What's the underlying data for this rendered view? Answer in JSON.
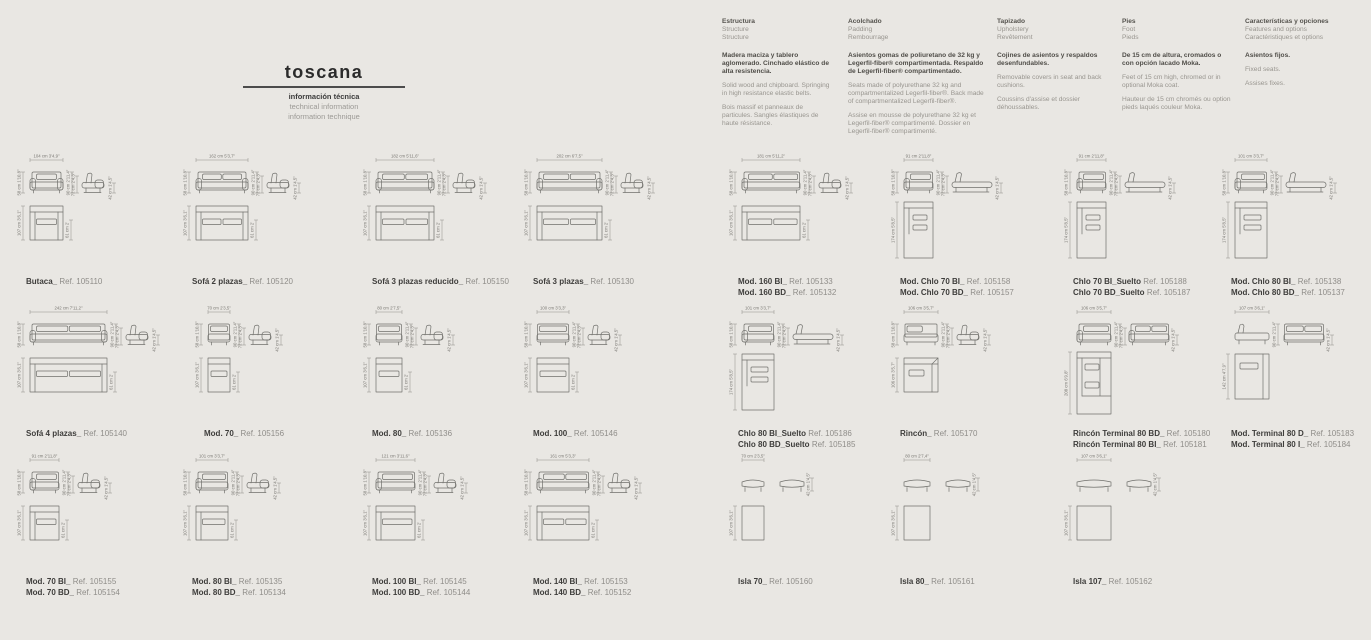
{
  "colors": {
    "background": "#e9e7e3",
    "line": "#70706c",
    "text_dark": "#3e3d3b",
    "text_muted": "#8f8d89"
  },
  "title": {
    "name": "toscana",
    "line1": "información técnica",
    "line2": "technical information",
    "line3": "information technique"
  },
  "info_columns": [
    {
      "heading": [
        "Estructura",
        "Structure",
        "Structure"
      ],
      "lead": "Madera maciza y tablero aglomerado. Cinchado elástico de alta resistencia.",
      "paragraphs": [
        "Solid wood and chipboard. Springing in high resistance elastic belts.",
        "Bois massif et panneaux de particules. Sangles élastiques de haute résistance."
      ]
    },
    {
      "heading": [
        "Acolchado",
        "Padding",
        "Rembourrage"
      ],
      "lead": "Asientos gomas de poliuretano de 32 kg y Legerfil-fiber® compartimentada. Respaldo de Legerfil-fiber® compartimentado.",
      "paragraphs": [
        "Seats made of polyurethane 32 kg and compartmentalized Legerfil-fiber®. Back made of compartmentalized Legerfil-fiber®.",
        "Assise en mousse de polyurethane 32 kg et Legerfil-fiber® compartimenté. Dossier en Legerfil-fiber® compartimenté."
      ]
    },
    {
      "heading": [
        "Tapizado",
        "Upholstery",
        "Revêtement"
      ],
      "lead": "Cojines de asientos y respaldos desenfundables.",
      "paragraphs": [
        "Removable covers in seat and back cushions.",
        "Coussins d'assise et dossier déhoussables."
      ]
    },
    {
      "heading": [
        "Pies",
        "Foot",
        "Pieds"
      ],
      "lead": "De 15 cm de altura, cromados o con opción lacado Moka.",
      "paragraphs": [
        "Feet of 15 cm high, chromed or in optional Moka coat.",
        "Hauteur de 15 cm chromés ou option pieds laqués couleur Moka."
      ]
    },
    {
      "heading": [
        "Características y opciones",
        "Features and options",
        "Caractéristiques et options"
      ],
      "lead": "Asientos fijos.",
      "paragraphs": [
        "Fixed seats.",
        "Assises fixes."
      ]
    }
  ],
  "cells": [
    {
      "id": "butaca",
      "labels": [
        {
          "name": "Butaca_",
          "ref": "Ref. 105110"
        }
      ],
      "dims": {
        "w": "104 cm 3'4,9\"",
        "h1": "58 cm 1'10,8\"",
        "h2": "90 cm 2'11,4\"",
        "h3": "72 cm 2'4,3\"",
        "h4": "42 cm 1'4,5\"",
        "pd": "107 cm 3'6,1\"",
        "sd": "61 cm 2'"
      }
    },
    {
      "id": "sofa-2-plazas",
      "labels": [
        {
          "name": "Sofá 2 plazas_",
          "ref": "Ref. 105120"
        }
      ],
      "dims": {
        "w": "162 cm 5'3,7\"",
        "h1": "58 cm 1'10,8\"",
        "h2": "90 cm 2'11,4\"",
        "h3": "72 cm 2'4,3\"",
        "h4": "42 cm 1'4,5\"",
        "pd": "107 cm 3'6,1\"",
        "sd": "61 cm 2'"
      }
    },
    {
      "id": "sofa-3-plazas-reducido",
      "labels": [
        {
          "name": "Sofá 3 plazas reducido_",
          "ref": "Ref. 105150"
        }
      ],
      "dims": {
        "w": "182 cm 5'11,6\"",
        "h1": "58 cm 1'10,8\"",
        "h2": "90 cm 2'11,4\"",
        "h3": "72 cm 2'4,3\"",
        "h4": "42 cm 1'4,5\"",
        "pd": "107 cm 3'6,1\"",
        "sd": "61 cm 2'"
      }
    },
    {
      "id": "sofa-3-plazas",
      "labels": [
        {
          "name": "Sofá 3 plazas_",
          "ref": "Ref. 105130"
        }
      ],
      "dims": {
        "w": "202 cm 6'7,5\"",
        "h1": "58 cm 1'10,8\"",
        "h2": "90 cm 2'11,4\"",
        "h3": "72 cm 2'4,3\"",
        "h4": "42 cm 1'4,5\"",
        "pd": "107 cm 3'6,1\"",
        "sd": "61 cm 2'"
      }
    },
    {
      "id": "mod-160",
      "labels": [
        {
          "name": "Mod. 160 BI_",
          "ref": "Ref. 105133"
        },
        {
          "name": "Mod. 160 BD_",
          "ref": "Ref. 105132"
        }
      ],
      "dims": {
        "w": "181 cm 5'11,2\"",
        "h1": "58 cm 1'10,8\"",
        "h2": "90 cm 2'11,4\"",
        "h3": "72 cm 2'4,3\"",
        "h4": "42 cm 1'4,5\"",
        "pd": "107 cm 3'6,1\"",
        "sd": "61 cm 2'"
      }
    },
    {
      "id": "mod-chlo-70",
      "labels": [
        {
          "name": "Mod. Chlo 70 BI_",
          "ref": "Ref. 105158"
        },
        {
          "name": "Mod. Chlo 70 BD_",
          "ref": "Ref. 105157"
        }
      ],
      "dims": {
        "w": "91 cm 2'11,8\"",
        "h1": "58 cm 1'10,8\"",
        "h2": "90 cm 2'11,4\"",
        "h3": "72 cm 2'4,3\"",
        "h4": "42 cm 1'4,5\"",
        "pd": "174 cm 5'8,5\""
      }
    },
    {
      "id": "chlo-70-suelto",
      "labels": [
        {
          "name": "Chlo 70 BI_Suelto",
          "ref": "Ref. 105188"
        },
        {
          "name": "Chlo 70 BD_Suelto",
          "ref": "Ref. 105187"
        }
      ],
      "dims": {
        "w": "91 cm 2'11,8\"",
        "h1": "58 cm 1'10,8\"",
        "h2": "90 cm 2'11,4\"",
        "h3": "72 cm 2'4,3\"",
        "h4": "42 cm 1'4,5\"",
        "pd": "174 cm 5'8,5\""
      }
    },
    {
      "id": "mod-chlo-80",
      "labels": [
        {
          "name": "Mod. Chlo 80 BI_",
          "ref": "Ref. 105138"
        },
        {
          "name": "Mod. Chlo 80 BD_",
          "ref": "Ref. 105137"
        }
      ],
      "dims": {
        "w": "101 cm 3'3,7\"",
        "h1": "58 cm 1'10,8\"",
        "h2": "90 cm 2'11,4\"",
        "h3": "72 cm 2'4,3\"",
        "h4": "42 cm 1'4,5\"",
        "pd": "174 cm 5'8,5\""
      }
    },
    {
      "id": "sofa-4-plazas",
      "labels": [
        {
          "name": "Sofá 4 plazas_",
          "ref": "Ref. 105140"
        }
      ],
      "dims": {
        "w": "242 cm 7'11,2\"",
        "h1": "58 cm 1'10,8\"",
        "h2": "90 cm 2'11,4\"",
        "h3": "72 cm 2'4,3\"",
        "h4": "42 cm 1'4,5\"",
        "pd": "107 cm 3'6,1\"",
        "sd": "61 cm 2'"
      }
    },
    {
      "id": "mod-70",
      "labels": [
        {
          "name": "Mod. 70_",
          "ref": "Ref. 105156"
        }
      ],
      "dims": {
        "w": "70 cm 2'3,5\"",
        "h1": "58 cm 1'10,8\"",
        "h2": "90 cm 2'11,4\"",
        "h3": "72 cm 2'4,3\"",
        "h4": "42 cm 1'4,5\"",
        "pd": "107 cm 3'6,1\"",
        "sd": "61 cm 2'"
      }
    },
    {
      "id": "mod-80",
      "labels": [
        {
          "name": "Mod. 80_",
          "ref": "Ref. 105136"
        }
      ],
      "dims": {
        "w": "80 cm 2'7,5\"",
        "h1": "58 cm 1'10,8\"",
        "h2": "90 cm 2'11,4\"",
        "h3": "72 cm 2'4,3\"",
        "h4": "42 cm 1'4,5\"",
        "pd": "107 cm 3'6,1\"",
        "sd": "61 cm 2'"
      }
    },
    {
      "id": "mod-100",
      "labels": [
        {
          "name": "Mod. 100_",
          "ref": "Ref. 105146"
        }
      ],
      "dims": {
        "w": "100 cm 3'3,3\"",
        "h1": "58 cm 1'10,8\"",
        "h2": "90 cm 2'11,4\"",
        "h3": "72 cm 2'4,3\"",
        "h4": "42 cm 1'4,5\"",
        "pd": "107 cm 3'6,1\"",
        "sd": "61 cm 2'"
      }
    },
    {
      "id": "chlo-80-suelto",
      "labels": [
        {
          "name": "Chlo 80 BI_Suelto",
          "ref": "Ref. 105186"
        },
        {
          "name": "Chlo 80 BD_Suelto",
          "ref": "Ref. 105185"
        }
      ],
      "dims": {
        "w": "101 cm 3'3,7\"",
        "h1": "58 cm 1'10,8\"",
        "h2": "90 cm 2'11,4\"",
        "h3": "72 cm 2'4,3\"",
        "h4": "42 cm 1'4,5\"",
        "pd": "174 cm 5'8,5\""
      }
    },
    {
      "id": "rincon",
      "labels": [
        {
          "name": "Rincón_",
          "ref": "Ref. 105170"
        }
      ],
      "dims": {
        "w": "106 cm 3'5,7\"",
        "h1": "58 cm 1'10,8\"",
        "h2": "90 cm 2'11,4\"",
        "h3": "72 cm 2'4,3\"",
        "h4": "42 cm 1'4,5\"",
        "pd": "106 cm 3'5,7\""
      }
    },
    {
      "id": "rincon-terminal-80",
      "labels": [
        {
          "name": "Rincón Terminal 80 BD_",
          "ref": "Ref. 105180"
        },
        {
          "name": "Rincón Terminal 80 BI_",
          "ref": "Ref. 105181"
        }
      ],
      "dims": {
        "w": "106 cm 3'5,7\"",
        "h2": "90 cm 2'11,4\"",
        "h3": "72 cm 2'4,3\"",
        "h4": "42 cm 1'4,5\"",
        "pd": "208 cm 6'9,8\""
      }
    },
    {
      "id": "mod-terminal-80",
      "labels": [
        {
          "name": "Mod. Terminal 80 D_",
          "ref": "Ref. 105183"
        },
        {
          "name": "Mod. Terminal 80 I_",
          "ref": "Ref. 105184"
        }
      ],
      "dims": {
        "w": "107 cm 3'6,1\"",
        "h2": "90 cm 2'11,4\"",
        "h4": "42 cm 1'4,5\"",
        "pd": "142 cm 4'7,9\""
      }
    },
    {
      "id": "mod-70-bi-bd",
      "labels": [
        {
          "name": "Mod. 70 BI_",
          "ref": "Ref. 105155"
        },
        {
          "name": "Mod. 70 BD_",
          "ref": "Ref. 105154"
        }
      ],
      "dims": {
        "w": "91 cm 2'11,8\"",
        "h1": "58 cm 1'10,8\"",
        "h2": "90 cm 2'11,4\"",
        "h3": "72 cm 2'4,3\"",
        "h4": "42 cm 1'4,5\"",
        "pd": "107 cm 3'6,1\"",
        "sd": "61 cm 2'"
      }
    },
    {
      "id": "mod-80-bi-bd",
      "labels": [
        {
          "name": "Mod. 80 BI_",
          "ref": "Ref. 105135"
        },
        {
          "name": "Mod. 80 BD_",
          "ref": "Ref. 105134"
        }
      ],
      "dims": {
        "w": "101 cm 3'3,7\"",
        "h1": "58 cm 1'10,8\"",
        "h2": "90 cm 2'11,4\"",
        "h3": "72 cm 2'4,3\"",
        "h4": "42 cm 1'4,5\"",
        "pd": "107 cm 3'6,1\"",
        "sd": "61 cm 2'"
      }
    },
    {
      "id": "mod-100-bi-bd",
      "labels": [
        {
          "name": "Mod. 100 BI_",
          "ref": "Ref. 105145"
        },
        {
          "name": "Mod. 100 BD_",
          "ref": "Ref. 105144"
        }
      ],
      "dims": {
        "w": "121 cm 3'11,6\"",
        "h1": "58 cm 1'10,8\"",
        "h2": "90 cm 2'11,4\"",
        "h3": "72 cm 2'4,3\"",
        "h4": "42 cm 1'4,5\"",
        "pd": "107 cm 3'6,1\"",
        "sd": "61 cm 2'"
      }
    },
    {
      "id": "mod-140-bi-bd",
      "labels": [
        {
          "name": "Mod. 140 BI_",
          "ref": "Ref. 105153"
        },
        {
          "name": "Mod. 140 BD_",
          "ref": "Ref. 105152"
        }
      ],
      "dims": {
        "w": "161 cm 5'3,3\"",
        "h1": "58 cm 1'10,8\"",
        "h2": "90 cm 2'11,4\"",
        "h3": "72 cm 2'4,3\"",
        "h4": "42 cm 1'4,5\"",
        "pd": "107 cm 3'6,1\"",
        "sd": "61 cm 2'"
      }
    },
    {
      "id": "isla-70",
      "labels": [
        {
          "name": "Isla 70_",
          "ref": "Ref. 105160"
        }
      ],
      "dims": {
        "w": "70 cm 2'3,5\"",
        "h4": "42 cm 1'4,5\"",
        "pd": "107 cm 3'6,1\""
      }
    },
    {
      "id": "isla-80",
      "labels": [
        {
          "name": "Isla 80_",
          "ref": "Ref. 105161"
        }
      ],
      "dims": {
        "w": "80 cm 2'7,4\"",
        "h4": "42 cm 1'4,5\"",
        "pd": "107 cm 3'6,1\""
      }
    },
    {
      "id": "isla-107",
      "labels": [
        {
          "name": "Isla 107_",
          "ref": "Ref. 105162"
        }
      ],
      "dims": {
        "w": "107 cm 3'6,1\"",
        "h4": "42 cm 1'4,5\"",
        "pd": "107 cm 3'6,1\""
      }
    }
  ]
}
